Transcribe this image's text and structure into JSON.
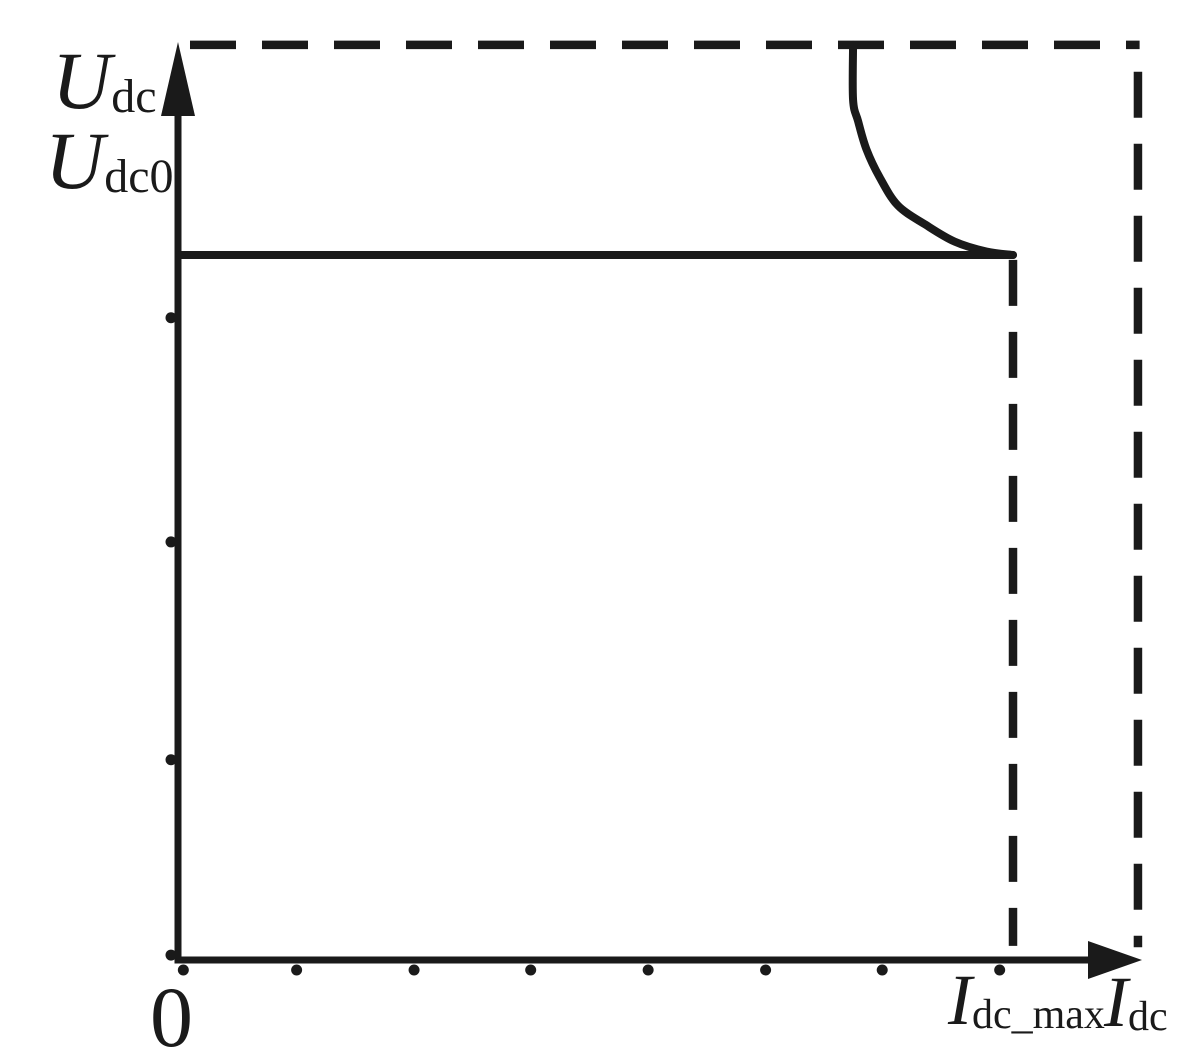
{
  "figure": {
    "background": "#ffffff",
    "ink_color": "#1a1a1a"
  },
  "labels": {
    "u_dc": {
      "base": "U",
      "sub": "dc"
    },
    "u_dc0": {
      "base": "U",
      "sub": "dc0"
    },
    "origin": "0",
    "i_dc_max": {
      "base": "I",
      "sub": "dc_max"
    },
    "i_dc": {
      "base": "I",
      "sub": "dc"
    }
  },
  "chart_data": {
    "type": "line",
    "xlabel": "I_dc",
    "ylabel": "U_dc",
    "x_unit": "normalized to I_dc_max",
    "y_unit": "normalized to U_dc0",
    "xlim": [
      0,
      1.15
    ],
    "ylim": [
      0,
      1.3
    ],
    "grid": false,
    "legend": false,
    "series": [
      {
        "key": "constant-voltage-segment",
        "name": "Constant-voltage segment (U = U_dc0)",
        "style": "solid",
        "smooth": false,
        "points": [
          [
            0,
            1.0
          ],
          [
            1.0,
            1.0
          ]
        ]
      },
      {
        "key": "current-limit-curve",
        "name": "Fold-back / current-limit curve",
        "style": "solid",
        "smooth": true,
        "points": [
          [
            0.808,
            1.298
          ],
          [
            0.808,
            1.22
          ],
          [
            0.814,
            1.19
          ],
          [
            0.824,
            1.15
          ],
          [
            0.84,
            1.11
          ],
          [
            0.862,
            1.07
          ],
          [
            0.895,
            1.043
          ],
          [
            0.93,
            1.019
          ],
          [
            0.968,
            1.005
          ],
          [
            1.0,
            1.0
          ]
        ]
      }
    ],
    "boundary_segments": [
      {
        "key": "max-voltage-boundary",
        "name": "Maximum-voltage dashed boundary",
        "style": "dashed",
        "from": [
          0.012,
          1.298
        ],
        "to": [
          1.152,
          1.298
        ]
      },
      {
        "key": "right-boundary",
        "name": "Right dashed boundary",
        "style": "dashed",
        "from": [
          1.15,
          1.26
        ],
        "to": [
          1.15,
          0.018
        ]
      },
      {
        "key": "max-current-line",
        "name": "I_dc_max dashed vertical line",
        "style": "dashed",
        "from": [
          1.0,
          0.993
        ],
        "to": [
          1.0,
          0.02
        ]
      }
    ],
    "annotations": [
      {
        "text": "U_dc0",
        "meaning": "regulated output voltage level (solid horizontal line)",
        "value_normalized": 1.0
      },
      {
        "text": "I_dc_max",
        "meaning": "maximum output current (dashed vertical line)",
        "value_normalized": 1.0
      },
      {
        "text": "0",
        "meaning": "origin"
      }
    ],
    "x_ticks_normalized": [
      0.004,
      0.14,
      0.281,
      0.421,
      0.562,
      0.703,
      0.843,
      0.984
    ],
    "y_ticks_normalized": [
      0.007,
      0.284,
      0.593,
      0.911
    ]
  }
}
